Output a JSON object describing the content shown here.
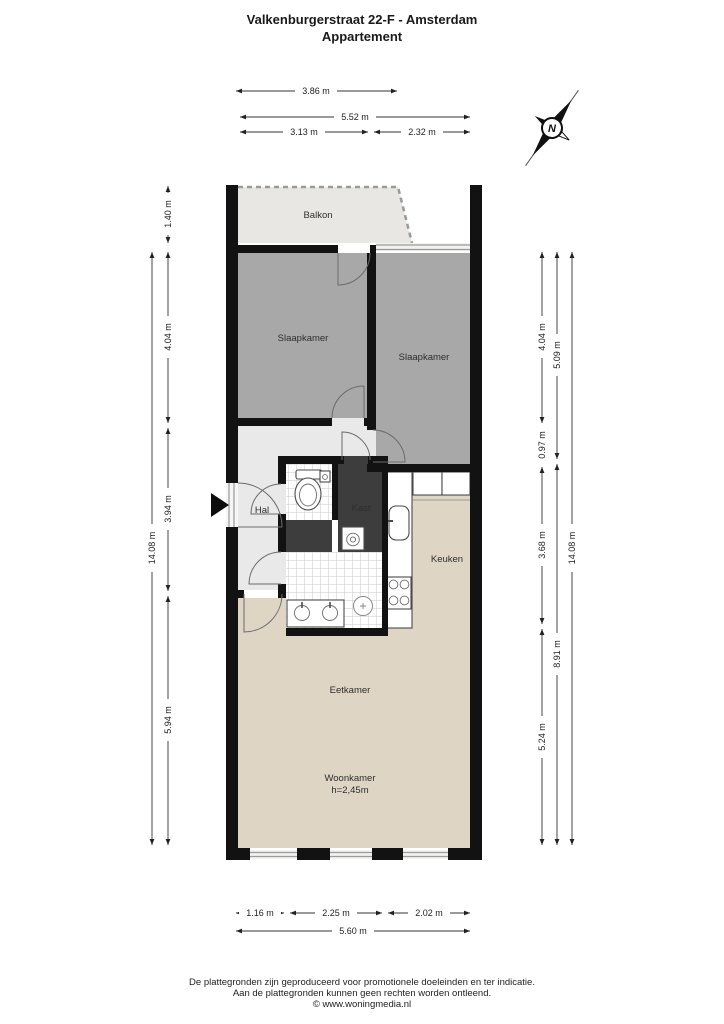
{
  "title": {
    "line1": "Valkenburgerstraat 22-F - Amsterdam",
    "line2": "Appartement"
  },
  "compass": {
    "label": "N"
  },
  "rooms": {
    "balkon": "Balkon",
    "slaapkamer1": "Slaapkamer",
    "slaapkamer2": "Slaapkamer",
    "hal": "Hal",
    "kast": "Kast",
    "keuken": "Keuken",
    "eetkamer": "Eetkamer",
    "woonkamer": "Woonkamer",
    "woonkamer_height": "h=2,45m"
  },
  "dimensions": {
    "top1": "3.86 m",
    "top2": "5.52 m",
    "top3a": "3.13 m",
    "top3b": "2.32 m",
    "left1": "1.40 m",
    "left2": "4.04 m",
    "left3": "3.94 m",
    "left4": "5.94 m",
    "left_total": "14.08 m",
    "rightA1": "4.04 m",
    "rightA2": "0.97 m",
    "rightA3": "3.68 m",
    "rightA4": "5.24 m",
    "rightB1": "5.09 m",
    "rightB2": "8.91 m",
    "right_total": "14.08 m",
    "bottom1": "1.16 m",
    "bottom2": "2.25 m",
    "bottom3": "2.02 m",
    "bottom_total": "5.60 m"
  },
  "footer": {
    "line1": "De plattegronden zijn geproduceerd voor promotionele doeleinden en ter indicatie.",
    "line2": "Aan de plattegronden kunnen geen rechten worden ontleend.",
    "line3": "© www.woningmedia.nl"
  },
  "colors": {
    "wall": "#121212",
    "bedroom_floor": "#a8a8a8",
    "balcony_floor": "#e8e7e4",
    "hall_floor": "#e9e9e9",
    "closet_floor": "#3d3d3d",
    "living_floor": "#ded5c5"
  }
}
